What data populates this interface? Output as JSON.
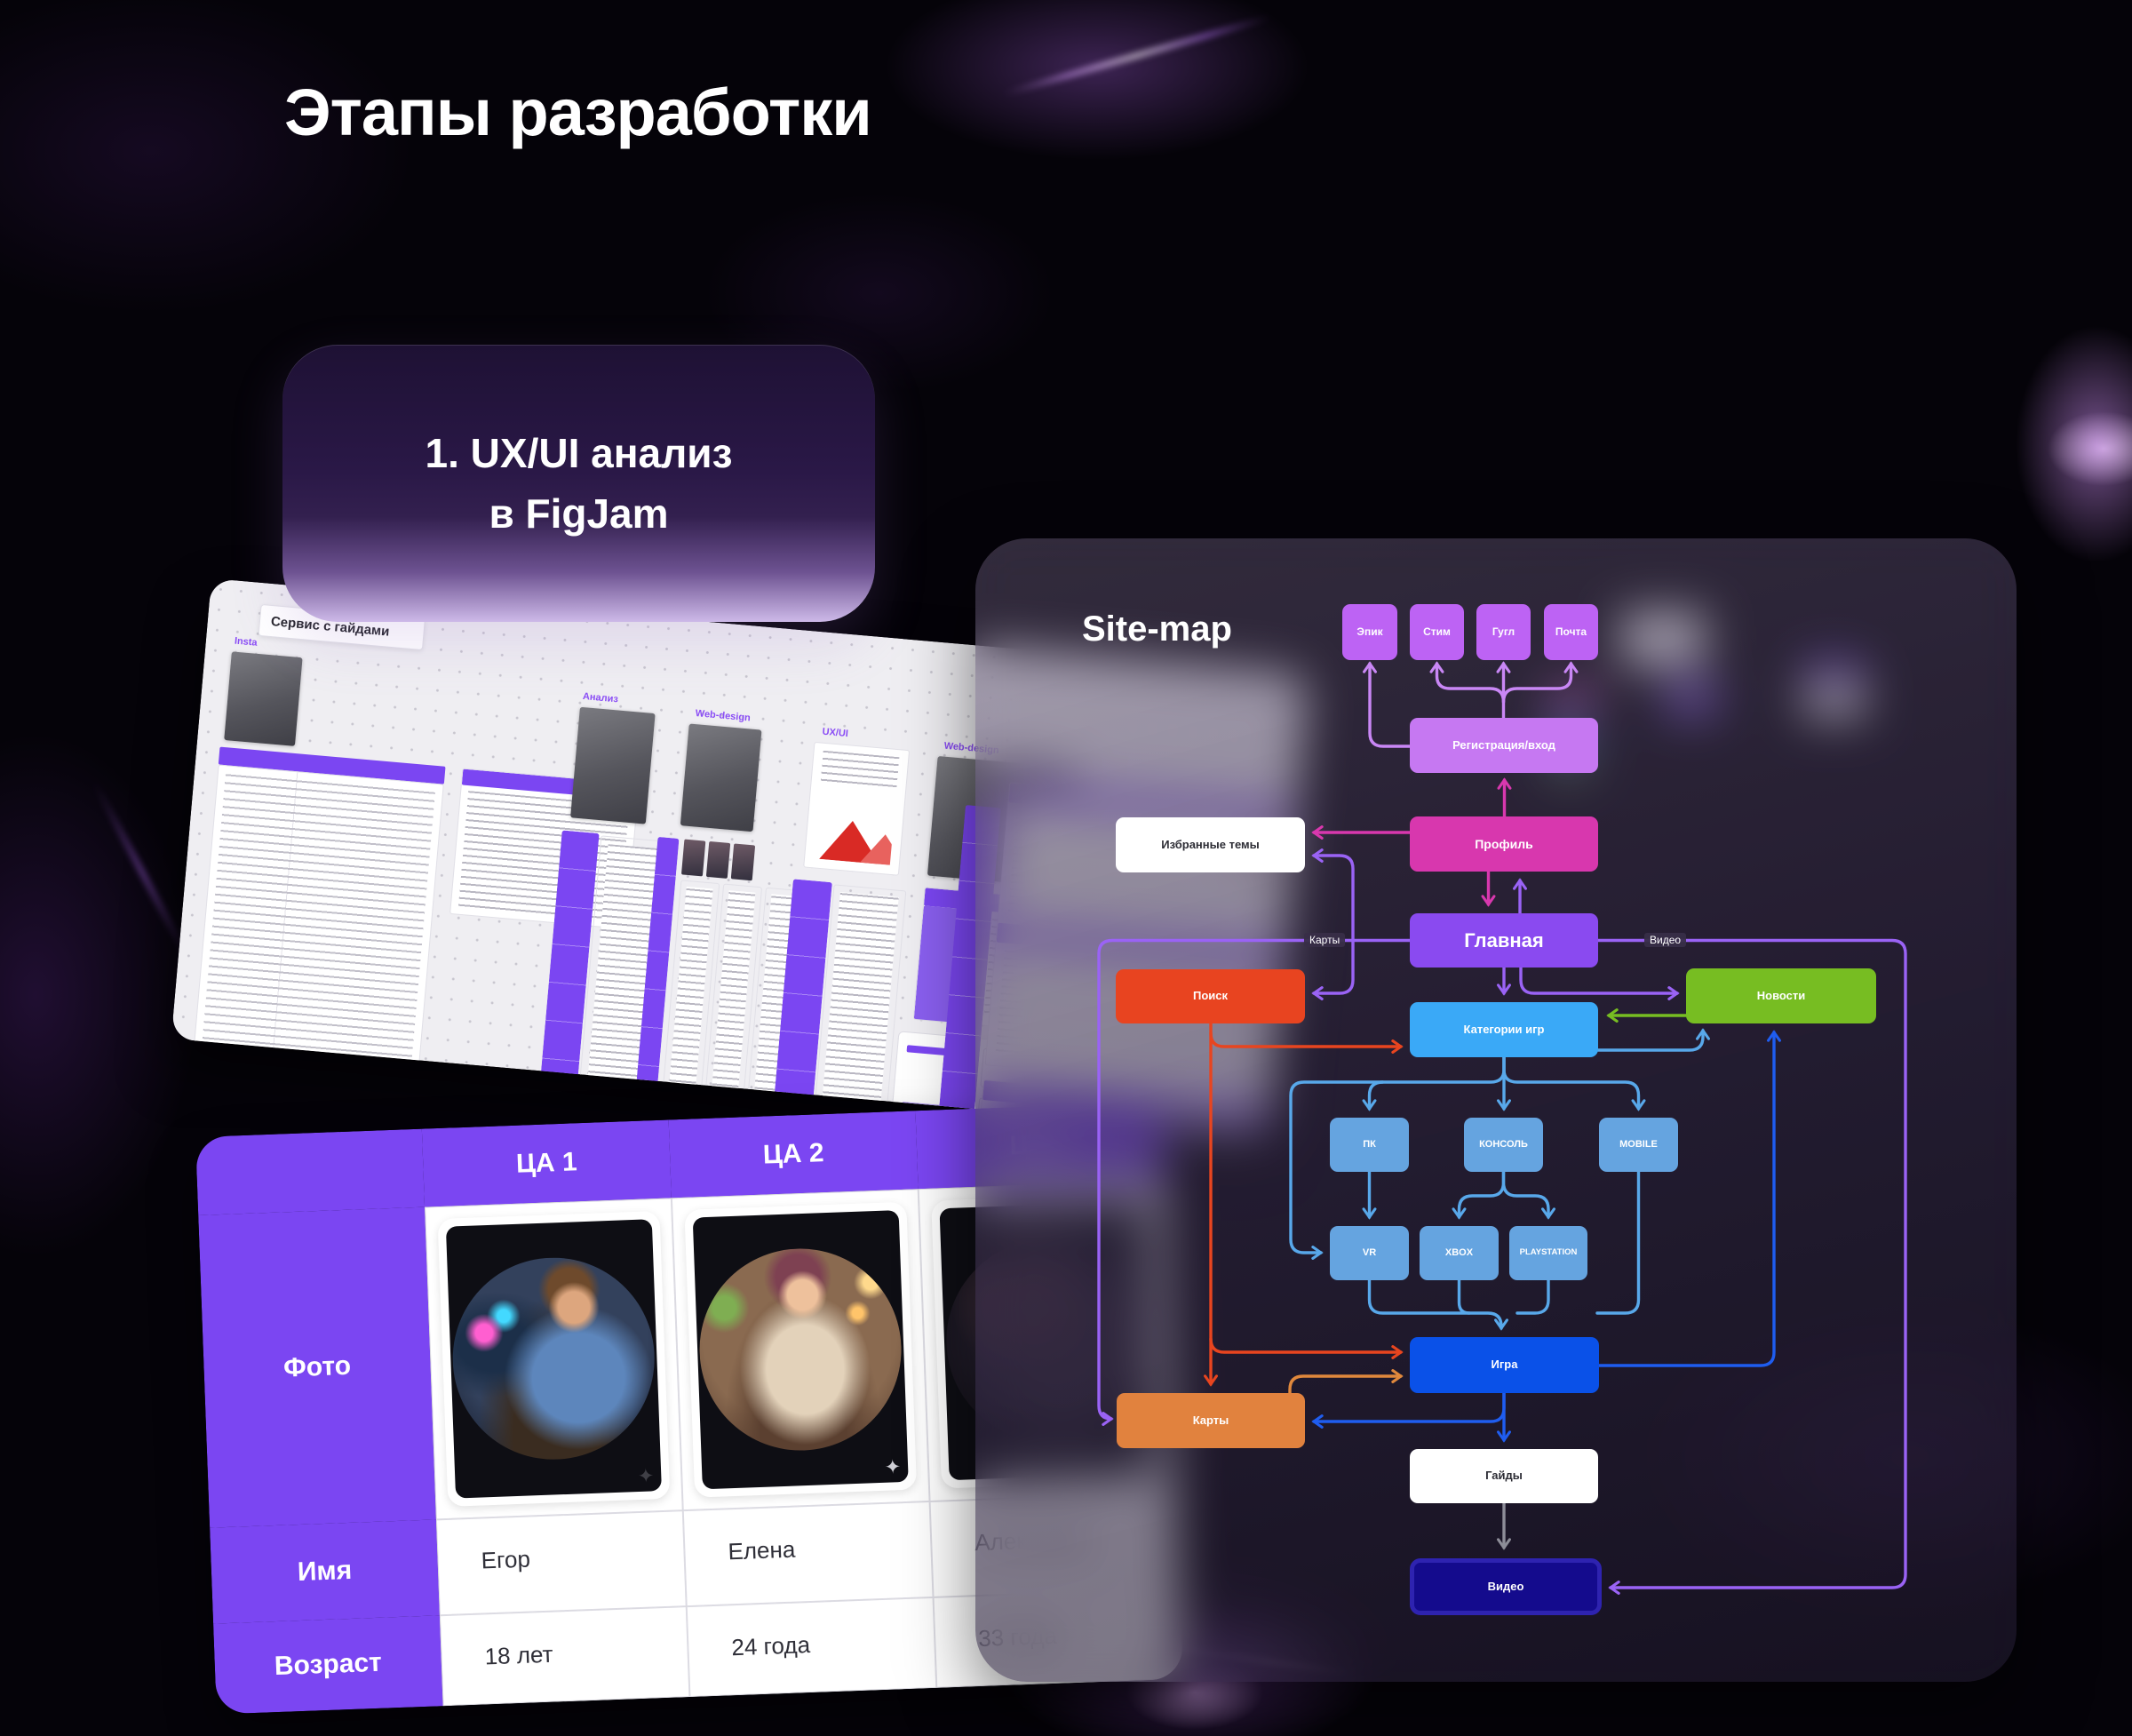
{
  "title": "Этапы разработки",
  "step_card": {
    "line1": "1. UX/UI анализ",
    "line2": "в FigJam"
  },
  "figjam": {
    "board_label": "Сервис с гайдами",
    "sections": [
      "Insta",
      "Анализ",
      "Web-design",
      "UX/UI",
      "Web-design"
    ]
  },
  "audience_table": {
    "col_headers": [
      "ЦА 1",
      "ЦА 2",
      "ЦА 3"
    ],
    "row_headers": [
      "Фото",
      "Имя",
      "Возраст"
    ],
    "names": [
      "Егор",
      "Елена",
      "Александр"
    ],
    "ages": [
      "18 лет",
      "24 года",
      "33 года"
    ]
  },
  "sitemap": {
    "title": "Site-map",
    "nodes": {
      "epic": "Эпик",
      "steam": "Стим",
      "google": "Гугл",
      "mail": "Почта",
      "registration": "Регистрация/вход",
      "favorites": "Избранные темы",
      "profile": "Профиль",
      "home": "Главная",
      "search": "Поиск",
      "categories": "Категории игр",
      "news": "Новости",
      "pc": "ПК",
      "console": "КОНСОЛЬ",
      "mobile": "MOBILE",
      "vr": "VR",
      "xbox": "XBOX",
      "playstation": "PLAYSTATION",
      "game": "Игра",
      "maps": "Карты",
      "guides": "Гайды",
      "video": "Видео"
    },
    "line_labels": {
      "maps": "Карты",
      "video": "Видео"
    },
    "colors": {
      "violet_node": "#bd63f4",
      "registration": "#c678f2",
      "magenta": "#d837ae",
      "home": "#8a4af0",
      "search": "#e84420",
      "categories": "#3aa9f7",
      "news": "#77bd22",
      "platform": "#65a4e0",
      "game": "#0a51e8",
      "maps": "#e1823e",
      "video_fill": "#140b8d",
      "video_border": "#2e23b0",
      "table_purple": "#7b46f2"
    }
  }
}
